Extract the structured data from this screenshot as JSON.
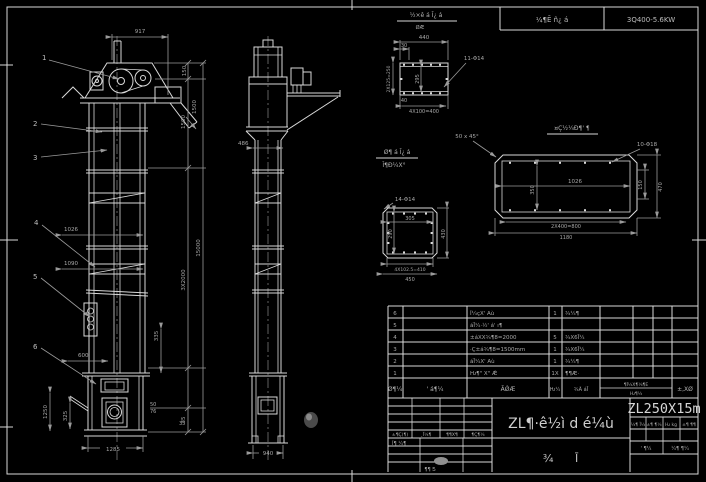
{
  "colors": {
    "background": "#000000",
    "line": "#d9d9d9",
    "dim": "#9a9a9a",
    "text": "#b4b4b4"
  },
  "top_strip": {
    "cell_mid": "¼¶Ē ñ¿ á",
    "cell_right": "3Q400-5.6KW"
  },
  "balloons": [
    "1",
    "2",
    "3",
    "4",
    "5",
    "6"
  ],
  "dims": {
    "d917": "917",
    "d1026": "1026",
    "d1090": "1090",
    "d600": "600",
    "d1250": "1250",
    "d325": "325",
    "d1285": "1285",
    "d335": "335",
    "d50": "50",
    "d76": "76",
    "d35b": "35",
    "d150": "150",
    "d1500a": "1500",
    "d1500b": "1500",
    "d3x2000": "3X2000",
    "d15000": "15000",
    "d35a": "35",
    "d486": "486",
    "d940": "940"
  },
  "details": {
    "a": {
      "title": "½×ê á Ī¿ á",
      "scale": "ØÆ",
      "holes": "11-Φ14",
      "top": "440",
      "d30": "30",
      "left": "2X125=250",
      "inner": "295",
      "d40": "40",
      "bottom": "4X100=400"
    },
    "note45": "50 x 45°",
    "b": {
      "title": "¤Ç½¼Ð¶' ¶",
      "holes": "10-Φ18",
      "inner": "1026",
      "left": "350",
      "right1": "150",
      "right2": "470",
      "bottom1": "2X400=800",
      "bottom2": "1180"
    },
    "c": {
      "title1": "Ø¶ á Ī¿ á",
      "title2": "Ĭ¶Ð¼X°",
      "holes": "14-Φ14",
      "inner_w": "305",
      "inner_h": "290",
      "right": "430",
      "bottom1": "4X102.5=410",
      "bottom2": "450"
    }
  },
  "bom": {
    "header": {
      "no": "Ø¶¼",
      "code": "' á¶¼",
      "name": "ÃǾÆ",
      "qty": "Ƕ¼",
      "mat": "¾Ã áĪ",
      "wt1": "¶Ĩ¼X¶¼¶E",
      "wt2": "Ƕ¶¼",
      "note": "±,XØ"
    },
    "rows": [
      {
        "no": "6",
        "desc": "Ĭ¼çX' Aù",
        "qty": "1",
        "mat": "¾¼¶"
      },
      {
        "no": "5",
        "desc": "áĪ¼·½' á' ı¶",
        "qty": "",
        "mat": ""
      },
      {
        "no": "4",
        "desc": "±áXX¾¶8=2000",
        "qty": "5",
        "mat": "¾X6Ī¼"
      },
      {
        "no": "3",
        "desc": "·Ç±á¾¶8=1500mm",
        "qty": "1",
        "mat": "¾X6Ī¼"
      },
      {
        "no": "2",
        "desc": "áĪ¼X' Aù",
        "qty": "1",
        "mat": "¾¼¶"
      },
      {
        "no": "1",
        "desc": "Ƕ¶\" X\" Ǽ",
        "qty": "1X",
        "mat": "¶¶Æ·"
      }
    ]
  },
  "title_block": {
    "model": "ZL250X15m",
    "title": "ZL¶·ê½ì d é¼ù",
    "subtitle": "¾ Ī",
    "rev_header": [
      "±¶Ç(¶)",
      "¸Ĭ¼¶",
      "¶¶X¶",
      "¶Ç¶¼"
    ],
    "rev_row": "Ĭ¶  ¼¶",
    "rev_bottom": "¶¶  Ƽ",
    "right_cells": [
      "¼¶ Ĭ¼",
      "±¶ ¶¼",
      "Ƕ kg",
      "±¶ ¶¶"
    ],
    "right_row": [
      "' ¶¼",
      "¼¶ ¶¼"
    ]
  }
}
